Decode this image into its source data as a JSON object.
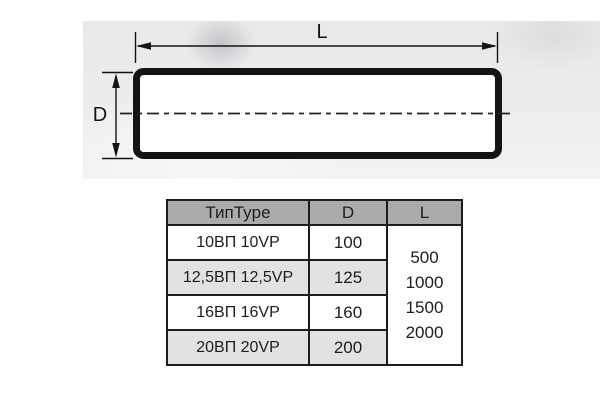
{
  "drawing": {
    "length_label": "L",
    "diameter_label": "D",
    "line_color": "#1a1a1a",
    "body_fill": "#ffffff"
  },
  "table": {
    "columns": [
      "ТипType",
      "D",
      "L"
    ],
    "rows": [
      {
        "type": "10ВП 10VP",
        "d": "100"
      },
      {
        "type": "12,5ВП 12,5VP",
        "d": "125"
      },
      {
        "type": "16ВП 16VP",
        "d": "160"
      },
      {
        "type": "20ВП 20VP",
        "d": "200"
      }
    ],
    "l_values": [
      "500",
      "1000",
      "1500",
      "2000"
    ],
    "colors": {
      "header_bg": "#ababab",
      "alt_row_bg": "#e2e2e3",
      "border": "#1d1d1d",
      "text": "#1d1d1d"
    }
  }
}
